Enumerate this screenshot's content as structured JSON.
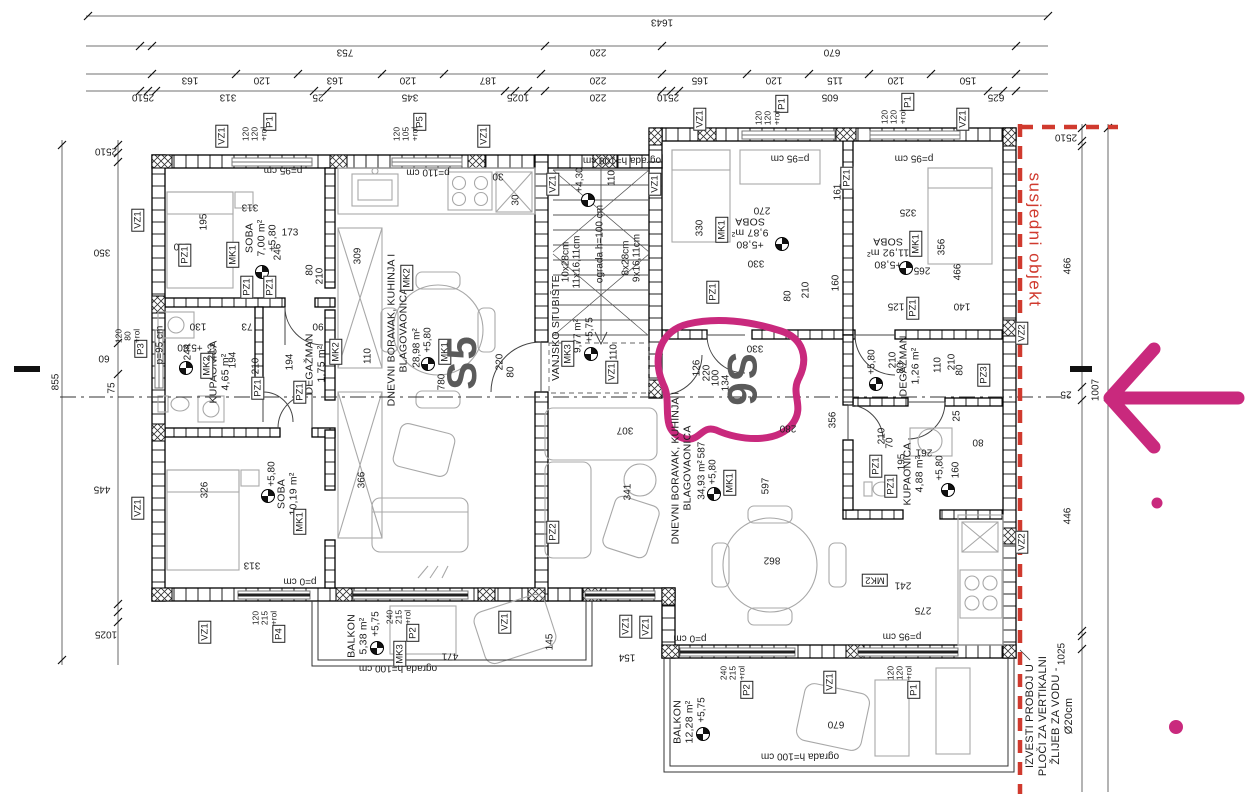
{
  "units": {
    "left": "S5",
    "right": "S6"
  },
  "annotations": {
    "neighbor_label": "susjedni objekt",
    "note_lines": [
      "IZVESTI PROBOJ U",
      "PLOČI ZA VERTIKALNI",
      "ŽLIJEB ZA VODU -",
      "Ø20cm"
    ],
    "highlight_color": "#c9297d",
    "boundary_color": "#d03a2e"
  },
  "levels": {
    "p580": "+5,80",
    "p575": "+5,75",
    "p430": "+4,30"
  },
  "rooms": {
    "s5_soba1": {
      "name": "SOBA",
      "area": "7,00 m²"
    },
    "s5_kupaonica": {
      "name": "KUPAONICA",
      "area": "4,65 m²"
    },
    "s5_degazman": {
      "name": "DEGAŽMAN",
      "area": "1,75 m²"
    },
    "s5_soba2": {
      "name": "SOBA",
      "area": "10,19 m²"
    },
    "s5_dnevni": {
      "name": "DNEVNI BORAVAK, KUHINJA I",
      "name2": "BLAGOVAONICA",
      "area": "28,98 m²"
    },
    "stubiste": {
      "name": "VANJSKO STUBIŠTE",
      "area": "9,77 m²"
    },
    "s6_soba1": {
      "name": "SOBA",
      "area": "9,87 m²"
    },
    "s6_soba2": {
      "name": "SOBA",
      "area": "11,92 m²"
    },
    "s6_degazman": {
      "name": "DEGAŽMAN",
      "area": "1,26 m²"
    },
    "s6_kupaonica": {
      "name": "KUPAONICA",
      "area": "4,88 m²"
    },
    "s6_dnevni": {
      "name": "DNEVNI BORAVAK, KUHINJA I",
      "name2": "BLAGOVAONICA",
      "area": "34,93 m²"
    },
    "balkon1": {
      "name": "BALKON",
      "area": "5,38 m²"
    },
    "balkon2": {
      "name": "BALKON",
      "area": "12,28 m²"
    }
  },
  "stairs": {
    "f1a": "10x28cm",
    "f1b": "11x16,11cm",
    "f2a": "8x28cm",
    "f2b": "9x16,11cm",
    "railing": "ograda h=100 cm"
  },
  "sills": {
    "p95": "p=95 cm",
    "p110": "p=110 cm",
    "p0": "p=0 cm"
  },
  "tags": {
    "vz1": "VZ1",
    "vz2": "VZ2",
    "pz1": "PZ1",
    "pz2": "PZ2",
    "pz3": "PZ3",
    "p1": "P1",
    "p2": "P2",
    "p3": "P3",
    "p4": "P4",
    "p5": "P5",
    "mk1": "MK1",
    "mk2": "MK2",
    "mk3": "MK3"
  },
  "win": {
    "p1": [
      "120",
      "120",
      "+rol"
    ],
    "p2": [
      "240",
      "215",
      "+rol"
    ],
    "p3": [
      "120",
      "80",
      "+rol"
    ],
    "p4": [
      "120",
      "215",
      "+rol"
    ],
    "p5": [
      "120",
      "105",
      "+rol"
    ]
  },
  "t": {
    "1643": "1643",
    "753": "753",
    "220": "220",
    "670": "670",
    "163": "163",
    "120": "120",
    "187": "187",
    "165": "165",
    "115": "115",
    "150": "150",
    "2510": "2510",
    "313": "313",
    "25": "25",
    "345": "345",
    "1025": "1025",
    "605": "605",
    "625": "625",
    "855": "855",
    "350": "350",
    "60": "60",
    "75": "75",
    "445": "445",
    "466": "466",
    "1007": "1007",
    "446": "446",
    "195": "195",
    "173": "173",
    "140": "140",
    "246": "246",
    "309": "309",
    "130": "130",
    "244": "244",
    "213": "213",
    "194": "194",
    "210": "210",
    "110": "110",
    "80": "80",
    "90": "90",
    "73": "73",
    "326": "326",
    "366": "366",
    "780": "780",
    "270": "270",
    "330": "330",
    "126": "126",
    "100": "100",
    "134": "134",
    "161": "161",
    "160": "160",
    "325": "325",
    "265": "265",
    "356": "356",
    "125": "125",
    "307": "307",
    "587": "587",
    "341": "341",
    "597": "597",
    "862": "862",
    "280": "280",
    "261": "261",
    "70": "70",
    "241": "241",
    "275": "275",
    "471": "471",
    "145": "145",
    "154": "154",
    "30": "30"
  }
}
